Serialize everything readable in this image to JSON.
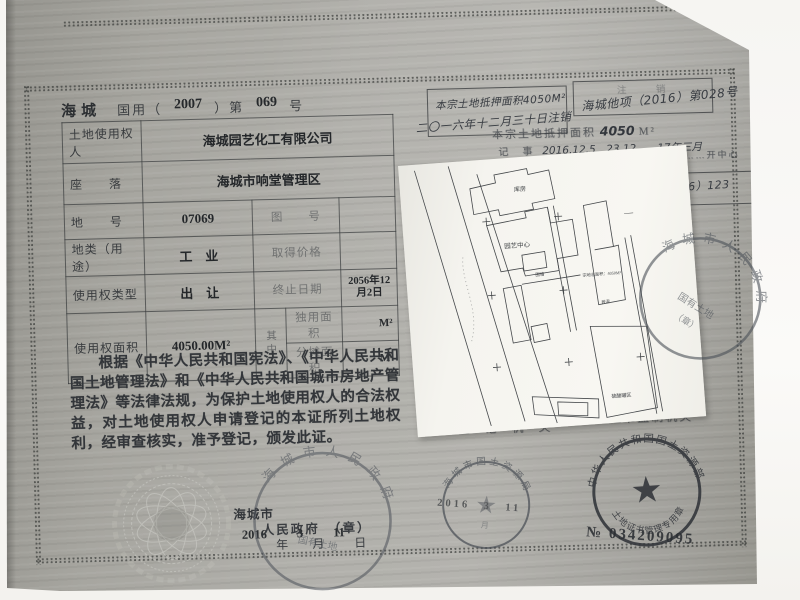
{
  "certificate": {
    "region": "海城",
    "serial": {
      "prefix": "国用（",
      "year": "2007",
      "mid": "）第",
      "number": "069",
      "suffix": "号"
    },
    "table": {
      "row1": {
        "label": "土地使用权人",
        "value": "海城园艺化工有限公司"
      },
      "row2": {
        "label": "座　　落",
        "value": "海城市响堂管理区"
      },
      "row3": {
        "label": "地　　号",
        "value": "07069",
        "label2": "图　　号",
        "value2": ""
      },
      "row4": {
        "label": "地类（用途）",
        "value": "工　业",
        "label2": "取得价格",
        "value2": ""
      },
      "row5": {
        "label": "使用权类型",
        "value": "出　让",
        "label2": "终止日期",
        "value2": "2056年12月2日"
      },
      "row6": {
        "label": "使用权面积",
        "value": "4050.00M²",
        "divider": "其中",
        "sub1_label": "独用面积",
        "sub1_value": "M²",
        "sub2_label": "分摊面积",
        "sub2_value": "M²"
      }
    },
    "decree": "根据《中华人民共和国宪法》、《中华人民共和国土地管理法》和《中华人民共和国城市房地产管理法》等法律法规，为保护土地使用权人的合法权益，对土地使用权人申请登记的本证所列土地权利，经审查核实，准予登记，颁发此证。",
    "issuer": {
      "line1": "海城市",
      "line2": "人民政府　（章）",
      "year": "2016",
      "year_label": "年",
      "month": "3",
      "month_label": "月",
      "day": "11",
      "day_label": "日"
    }
  },
  "records": {
    "note1_line1": "本宗土地抵押面积4050M²",
    "note1_line2": "二〇一六年十二月三十日注销",
    "note2_header": "注　销",
    "note2_value": "海城他项（2016）第028号",
    "mortgage_label": "本宗土地抵押面积",
    "mortgage_value": "4050",
    "mortgage_unit": "M²",
    "record_label": "记　事",
    "record_value": "2016.12.5　23.12——17年三月",
    "partial_text": "……开中心",
    "note3_value": "D（2016）123",
    "registrar_label": "登 记 机 关",
    "supervisor_label": "证书监制机关"
  },
  "map": {
    "labels": {
      "top_building": "库房",
      "center_building": "园艺中心",
      "wall": "围墙",
      "area_note": "宗地总面积：4050M²",
      "structure": "砖混",
      "bottom_building": "硫酸罐区",
      "dash": "—"
    }
  },
  "stamps": {
    "city_gov_map": {
      "arc": "海城市人民政府",
      "inner1": "国有土地",
      "inner2": "（章）"
    },
    "city_gov_bottom": {
      "arc": "海城市人民政府",
      "inner1": "国有土地"
    },
    "land_bureau": {
      "arc": "海城市国土资源局",
      "date": "2016　3　11",
      "sub_label": "月",
      "star": "★"
    },
    "ministry": {
      "arc_top": "中华人民共和国国土资源部",
      "arc_bottom": "土地证书管理专用章",
      "serial": "№ 034209095",
      "star": "★"
    }
  },
  "colors": {
    "paper": "#a8a7a2",
    "ink": "#44474a",
    "stamp_light": "#565c63",
    "stamp_dark": "#35383d",
    "backdrop": "#f7f6f3",
    "map_paper": "#f6f5f0"
  }
}
